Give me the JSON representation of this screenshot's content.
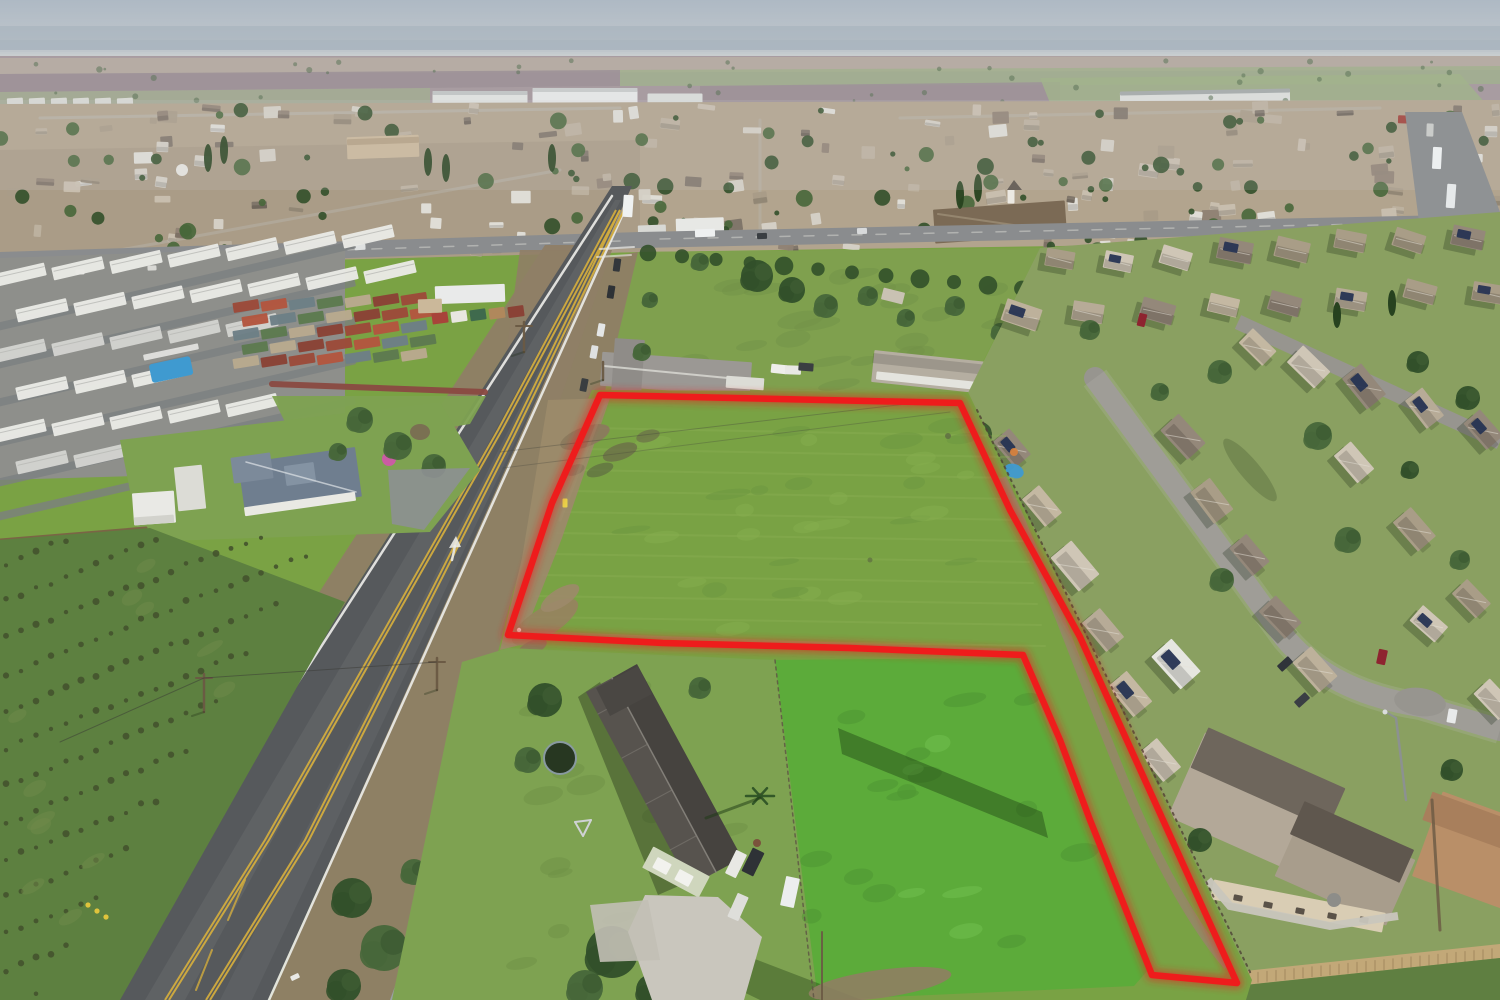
{
  "meta": {
    "type": "aerial-drone-photograph",
    "description": "Aerial real-estate photo of a vacant green land parcel outlined with a red boundary, beside a two-lane rural highway, mobile home park and orchard on the left, dense suburban tract housing on the right, hazy valley horizon at top",
    "annotation": "red property boundary outline"
  },
  "boundary": {
    "color": "#ee1c1c",
    "points": "600,395 960,403 1010,510 1080,637 1163,820 1237,983 1152,975 1090,820 1060,740 1023,655 850,648 663,643 508,635 523,590 552,503"
  },
  "palette": {
    "skyTop": "#aeb9c4",
    "skyHorizon": "#cdd1d2",
    "mountains": "#9fadb9",
    "haze": "#cfd3d4",
    "farMauve": "#99878e",
    "farMauve2": "#8b7a82",
    "farGreen": "#8fa671",
    "farTan": "#b0a294",
    "townBase": "#b2a48e",
    "townBase2": "#a59782",
    "asphalt": "#56595c",
    "asphaltWorn": "#888b8d",
    "shoulder": "#8f7e66",
    "laneYellow": "#d2ac3e",
    "laneWhite": "#ebebe7",
    "fieldGreen": "#79a244",
    "fieldGreenDark": "#6c9540",
    "fieldDirt": "#9c8a6a",
    "fieldWet": "#5e6c42",
    "pasture": "#5cab3a",
    "pastureLight": "#71bf4e",
    "lawn": "#7ea251",
    "subLawn": "#8aa061",
    "treeDark": "#32502a",
    "treeMid": "#47673a",
    "roofWhite": "#e9e9e5",
    "roofGrey": "#c7c4be",
    "roofSlate": "#6f7e8f",
    "roofDark": "#47443f",
    "roofTan": "#c4b8a2",
    "roofBrown": "#8c7e6c",
    "churchRoof": "#7b6a55",
    "wallTan": "#d9cdb4",
    "solar": "#273453",
    "concrete": "#c9c6bd",
    "streetGrey": "#97958f",
    "fenceTan": "#c2a878",
    "fenceBrown": "#7a5f46",
    "dirtTrail": "#97866a",
    "water": "#3f9ad0",
    "magenta": "#cf59a8",
    "orange": "#c06a32",
    "carRed": "#8e2430",
    "housePalette": [
      "#c4b8a2",
      "#bdb19b",
      "#cfc6b6",
      "#a99d87",
      "#b7ab97",
      "#94887a"
    ],
    "containerPalette": [
      "#9c4a3a",
      "#b3563f",
      "#6d7f86",
      "#5d7a4f",
      "#b9a98e",
      "#8a4236"
    ],
    "shedPalette": [
      "#a8433a",
      "#e8e6e0",
      "#3f6a4d",
      "#b0885c",
      "#8a4236",
      "#d8d8d2"
    ]
  }
}
